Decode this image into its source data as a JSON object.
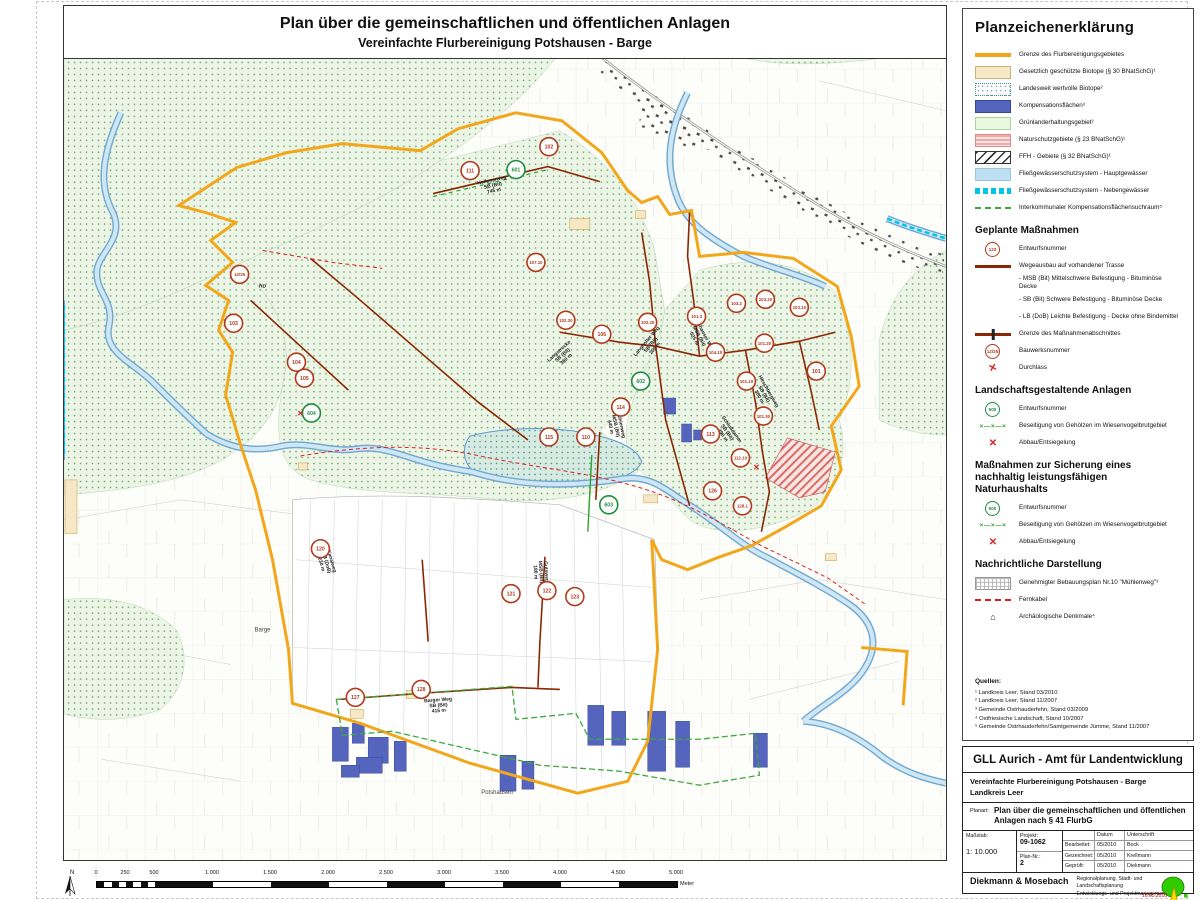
{
  "colors": {
    "boundary": "#F2A71B",
    "compensation": "#5565BD",
    "road_planned": "#8B2703",
    "marker_red": "#B03A1A",
    "marker_green": "#1E8E3E",
    "river": "#5b9bd5",
    "fernkabel": "#E02020",
    "nebengewaesser": "#00C5E8",
    "suchraum": "#3DA93D"
  },
  "page": {
    "title1": "Plan über die gemeinschaftlichen und öffentlichen Anlagen",
    "title2": "Vereinfachte Flurbereinigung Potshausen - Barge"
  },
  "legend": {
    "title": "Planzeichenerklärung",
    "groups": [
      {
        "heading": null,
        "items": [
          {
            "swatch": "orange",
            "label": "Grenze des Flurbereinigungsgebietes"
          },
          {
            "swatch": "cream",
            "label": "Gesetzlich geschützte Biotope (§ 30 BNatSchG)¹"
          },
          {
            "swatch": "dots",
            "label": "Landesweit wertvolle Biotope²"
          },
          {
            "swatch": "blue",
            "label": "Kompensationsflächen³"
          },
          {
            "swatch": "green",
            "label": "Grünlanderhaltungsgebiet²"
          },
          {
            "swatch": "pink",
            "label": "Naturschutzgebiete (§ 23 BNatSchG)¹"
          },
          {
            "swatch": "hatch",
            "label": "FFH - Gebiete (§ 32 BNatSchG)¹"
          },
          {
            "swatch": "lblue",
            "label": "Fließgewässerschutzsystem - Hauptgewässer"
          },
          {
            "swatch": "cyand",
            "label": "Fließgewässerschutzsystem - Nebengewässer"
          },
          {
            "swatch": "greend",
            "label": "Interkommunaler Kompensationsflächensuchraum⁵"
          }
        ]
      },
      {
        "heading": "Geplante Maßnahmen",
        "items": [
          {
            "swatch": "circr",
            "symbol": "123",
            "label": "Entwurfsnummer"
          },
          {
            "swatch": "dkred",
            "label": "Wegeausbau auf vorhandener Trasse"
          },
          {
            "swatch": "none",
            "label": "- MSB (Bit) Mittelschwere Befestigung - Bituminöse Decke"
          },
          {
            "swatch": "none",
            "label": "- SB (Bit) Schwere Befestigung - Bituminöse Decke"
          },
          {
            "swatch": "none",
            "label": "- LB (DoB) Leichte Befestigung - Decke ohne Bindemittel"
          },
          {
            "swatch": "cross",
            "label": "Grenze des Maßnahmenabschnittes"
          },
          {
            "swatch": "circr",
            "symbol": "12/25",
            "label": "Bauwerksnummer"
          },
          {
            "swatch": "durch",
            "symbol": "✕",
            "label": "Durchlass"
          }
        ]
      },
      {
        "heading": "Landschaftsgestaltende Anlagen",
        "items": [
          {
            "swatch": "circg",
            "symbol": "500",
            "label": "Entwurfsnummer"
          },
          {
            "swatch": "xxx",
            "symbol": "×—×—×",
            "label": "Beseitigung von Gehölzen im Wiesenvogelbrutgebiet"
          },
          {
            "swatch": "redx",
            "symbol": "✕",
            "label": "Abbau/Entsiegelung"
          }
        ]
      },
      {
        "heading": "Maßnahmen zur Sicherung eines nachhaltig leistungsfähigen Naturhaushalts",
        "items": [
          {
            "swatch": "circg",
            "symbol": "600",
            "label": "Entwurfsnummer"
          },
          {
            "swatch": "xxx",
            "symbol": "×—×—×",
            "label": "Beseitigung von Gehölzen im Wiesenvogelbrutgebiet"
          },
          {
            "swatch": "redx",
            "symbol": "✕",
            "label": "Abbau/Entsiegelung"
          }
        ]
      },
      {
        "heading": "Nachrichtliche Darstellung",
        "items": [
          {
            "swatch": "grid",
            "label": "Genehmigter Bebauungsplan Nr.10 \"Mühlenweg\"³"
          },
          {
            "swatch": "redd",
            "label": "Fernkabel"
          },
          {
            "swatch": "monu",
            "symbol": "⌂",
            "label": "Archäologische Denkmale⁴"
          }
        ]
      }
    ],
    "sources": {
      "heading": "Quellen:",
      "lines": [
        "¹ Landkreis Leer, Stand 03/2010",
        "² Landkreis Leer, Stand 11/2007",
        "³ Gemeinde Ostrhauderfehn, Stand 03/2009",
        "⁴ Ostfriesische Landschaft, Stand 10/2007",
        "⁵ Gemeinde Ostrhauderfehn/Samtgemeinde Jümme, Stand 11/2007"
      ]
    }
  },
  "title_block": {
    "agency": "GLL Aurich - Amt für Landentwicklung",
    "project_line1": "Vereinfachte Flurbereinigung Potshausen - Barge",
    "project_line2": "Landkreis Leer",
    "planart_label": "Planart:",
    "planart_value": "Plan über die gemeinschaftlichen und öffentlichen Anlagen nach § 41 FlurbG",
    "massstab_label": "Maßstab:",
    "massstab_value": "1: 10.000",
    "projekt_label": "Projekt:",
    "projekt_value": "09-1062",
    "plannr_label": "Plan-Nr.:",
    "plannr_value": "2",
    "col_datum": "Datum",
    "col_unterschrift": "Unterschrift",
    "rows": [
      {
        "label": "Bearbeitet:",
        "datum": "05/2010",
        "name": "Bock"
      },
      {
        "label": "Gezeichnet:",
        "datum": "05/2010",
        "name": "Krellmann"
      },
      {
        "label": "Geprüft:",
        "datum": "05/2010",
        "name": "Diekmann"
      }
    ],
    "firm_name": "Diekmann & Mosebach",
    "firm_desc1": "Regionalplanung, Stadt- und Landschaftsplanung",
    "firm_desc2": "Entwicklungs- und Projektmanagement",
    "firm_addr": "Oldenburger Straße 211 · 26180 Rastede · Tel. (04402) 91 16 30 · Fax 91 70 40",
    "plot_date": "16.05.2010"
  },
  "scale": {
    "labels": [
      "0",
      "250",
      "500",
      "1.000",
      "1.500",
      "2.000",
      "2.500",
      "3.000",
      "3.500",
      "4.000",
      "4.500",
      "5.000"
    ],
    "unit": "Meter"
  },
  "map": {
    "north_label": "N",
    "markers": [
      [
        470,
        170,
        "111",
        "r"
      ],
      [
        549,
        146,
        "102",
        "r"
      ],
      [
        516,
        169,
        "601",
        "g"
      ],
      [
        239,
        274,
        "12/25",
        "r"
      ],
      [
        233,
        323,
        "103",
        "r"
      ],
      [
        296,
        362,
        "104",
        "r"
      ],
      [
        304,
        378,
        "105",
        "r"
      ],
      [
        536,
        262,
        "107.10",
        "r"
      ],
      [
        566,
        320,
        "102.30",
        "r"
      ],
      [
        602,
        334,
        "106",
        "r"
      ],
      [
        648,
        322,
        "102.20",
        "r"
      ],
      [
        697,
        316,
        "101.3",
        "r"
      ],
      [
        737,
        303,
        "103.2",
        "r"
      ],
      [
        766,
        299,
        "103.20",
        "r"
      ],
      [
        800,
        307,
        "103.10",
        "r"
      ],
      [
        716,
        352,
        "104.10",
        "r"
      ],
      [
        765,
        343,
        "101.20",
        "r"
      ],
      [
        747,
        381,
        "101.10",
        "r"
      ],
      [
        817,
        371,
        "101",
        "r"
      ],
      [
        764,
        416,
        "101.30",
        "r"
      ],
      [
        711,
        434,
        "113",
        "r"
      ],
      [
        741,
        458,
        "112.10",
        "r"
      ],
      [
        713,
        491,
        "126",
        "r"
      ],
      [
        743,
        506,
        "128.1",
        "r"
      ],
      [
        586,
        437,
        "110",
        "r"
      ],
      [
        621,
        407,
        "114",
        "r"
      ],
      [
        549,
        437,
        "115",
        "r"
      ],
      [
        641,
        381,
        "602",
        "g"
      ],
      [
        311,
        413,
        "604",
        "g"
      ],
      [
        609,
        505,
        "603",
        "g"
      ],
      [
        320,
        549,
        "120",
        "r"
      ],
      [
        511,
        594,
        "121",
        "r"
      ],
      [
        547,
        591,
        "122",
        "r"
      ],
      [
        575,
        597,
        "123",
        "r"
      ],
      [
        355,
        698,
        "127",
        "r"
      ],
      [
        421,
        690,
        "128",
        "r"
      ]
    ],
    "road_labels": [
      [
        492,
        181,
        -12,
        [
          "Hollenerweg",
          "SB (Bit)",
          "745 m"
        ]
      ],
      [
        560,
        352,
        -42,
        [
          "Langstrecke",
          "SB (Bit)",
          "360 m"
        ]
      ],
      [
        648,
        342,
        -50,
        [
          "Langholter Weg",
          "SB (Bit)",
          "305 m"
        ]
      ],
      [
        703,
        334,
        62,
        [
          "Potshauser Weg",
          "MSB (Bit)",
          "525 m"
        ]
      ],
      [
        731,
        430,
        55,
        [
          "Schlußdamm",
          "SB (Bit)",
          "490 m"
        ]
      ],
      [
        620,
        425,
        78,
        [
          "Mühlenweg",
          "MSB (Bit)",
          "440 m"
        ]
      ],
      [
        438,
        702,
        -4,
        [
          "Barger Weg",
          "SB (Bit)",
          "415 m"
        ]
      ],
      [
        330,
        562,
        74,
        [
          "Kanalweg",
          "LB (DoB)",
          "230 m"
        ]
      ],
      [
        545,
        572,
        86,
        [
          "Gutsweg",
          "MSB (Bit)",
          "180 m"
        ]
      ],
      [
        768,
        392,
        60,
        [
          "Hirschbergweg",
          "SB (Bit)",
          "380 m"
        ]
      ],
      [
        262,
        287,
        0,
        [
          "RD"
        ]
      ]
    ],
    "place_labels": [
      [
        497,
        795,
        "Potshausen"
      ],
      [
        262,
        632,
        "Barge"
      ]
    ],
    "red_x": [
      [
        300,
        416
      ],
      [
        757,
        470
      ]
    ]
  }
}
